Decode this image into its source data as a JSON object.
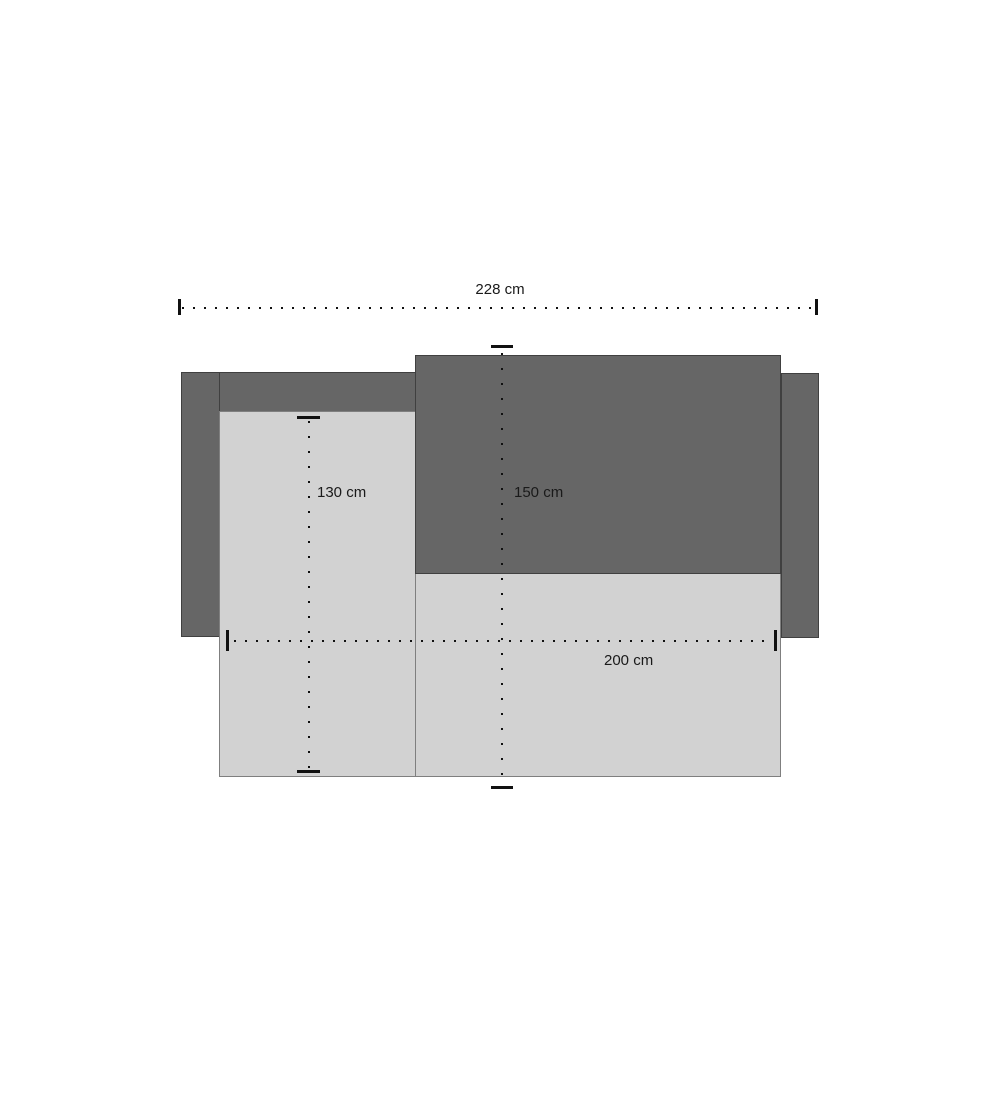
{
  "diagram": {
    "subject": "sofa-top-view-dimension-drawing",
    "dimensions": {
      "total_width_label": "228 cm",
      "left_section_depth_label": "130 cm",
      "right_section_depth_label": "150 cm",
      "seat_width_label": "200 cm"
    }
  },
  "colors": {
    "dark_fill": "#666666",
    "dark_border": "#404040",
    "light_fill": "#d2d2d2",
    "light_border": "#7f7f7f",
    "line_color": "#111111",
    "text_color": "#1a1a1a",
    "bg": "#ffffff"
  }
}
